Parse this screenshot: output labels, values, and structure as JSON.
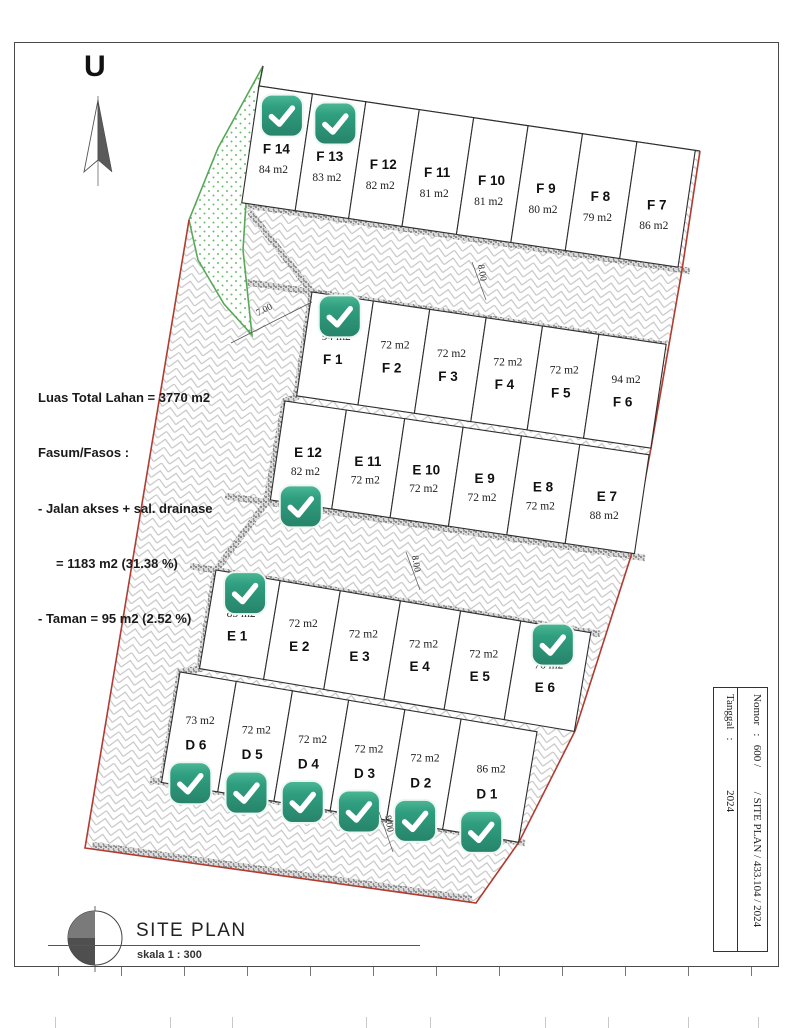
{
  "page": {
    "north_label": "U"
  },
  "info_block": {
    "lines": [
      "Luas Total Lahan = 3770 m2",
      "Fasum/Fasos :",
      "- Jalan akses + sal. drainase",
      "     = 1183 m2 (31.38 %)",
      "- Taman = 95 m2 (2.52 %)"
    ]
  },
  "legend": {
    "title": "SITE PLAN",
    "scale": "skala 1 : 300"
  },
  "title_block": {
    "nomor": "Nomor   :   600 /         / SITE PLAN / 433.104 / 2024",
    "tanggal": "Tanggal   :                  2024"
  },
  "dimensions": [
    "7.00",
    "8.00",
    "8.00",
    "9.00"
  ],
  "check_color": "#2f9e7f",
  "boundary_red": "#b23b30",
  "taman_green": "#58a858",
  "site": {
    "rows": [
      {
        "id": "row-F-top",
        "lots": [
          {
            "label": "F 14",
            "area": "84 m2",
            "checked": true
          },
          {
            "label": "F 13",
            "area": "83 m2",
            "checked": true
          },
          {
            "label": "F 12",
            "area": "82 m2",
            "checked": false
          },
          {
            "label": "F 11",
            "area": "81 m2",
            "checked": false
          },
          {
            "label": "F 10",
            "area": "81 m2",
            "checked": false
          },
          {
            "label": "F 9",
            "area": "80 m2",
            "checked": false
          },
          {
            "label": "F 8",
            "area": "79 m2",
            "checked": false
          },
          {
            "label": "F 7",
            "area": "86 m2",
            "checked": false
          }
        ]
      },
      {
        "id": "row-F-bottom",
        "lots": [
          {
            "label": "F 1",
            "area": "94 m2",
            "checked": true
          },
          {
            "label": "F 2",
            "area": "72 m2",
            "checked": false
          },
          {
            "label": "F 3",
            "area": "72 m2",
            "checked": false
          },
          {
            "label": "F 4",
            "area": "72 m2",
            "checked": false
          },
          {
            "label": "F 5",
            "area": "72 m2",
            "checked": false
          },
          {
            "label": "F 6",
            "area": "94 m2",
            "checked": false
          }
        ]
      },
      {
        "id": "row-E-top",
        "lots": [
          {
            "label": "E 12",
            "area": "82 m2",
            "checked": true
          },
          {
            "label": "E 11",
            "area": "72 m2",
            "checked": false
          },
          {
            "label": "E 10",
            "area": "72 m2",
            "checked": false
          },
          {
            "label": "E 9",
            "area": "72 m2",
            "checked": false
          },
          {
            "label": "E 8",
            "area": "72 m2",
            "checked": false
          },
          {
            "label": "E 7",
            "area": "88 m2",
            "checked": false
          }
        ]
      },
      {
        "id": "row-E-bottom",
        "lots": [
          {
            "label": "E 1",
            "area": "85 m2",
            "checked": true
          },
          {
            "label": "E 2",
            "area": "72 m2",
            "checked": false
          },
          {
            "label": "E 3",
            "area": "72 m2",
            "checked": false
          },
          {
            "label": "E 4",
            "area": "72 m2",
            "checked": false
          },
          {
            "label": "E 5",
            "area": "72 m2",
            "checked": false
          },
          {
            "label": "E 6",
            "area": "76 m2",
            "checked": true
          }
        ]
      },
      {
        "id": "row-D",
        "lots": [
          {
            "label": "D 6",
            "area": "73 m2",
            "checked": true
          },
          {
            "label": "D 5",
            "area": "72 m2",
            "checked": true
          },
          {
            "label": "D 4",
            "area": "72 m2",
            "checked": true
          },
          {
            "label": "D 3",
            "area": "72 m2",
            "checked": true
          },
          {
            "label": "D 2",
            "area": "72 m2",
            "checked": true
          },
          {
            "label": "D 1",
            "area": "86 m2",
            "checked": true
          }
        ]
      }
    ]
  }
}
